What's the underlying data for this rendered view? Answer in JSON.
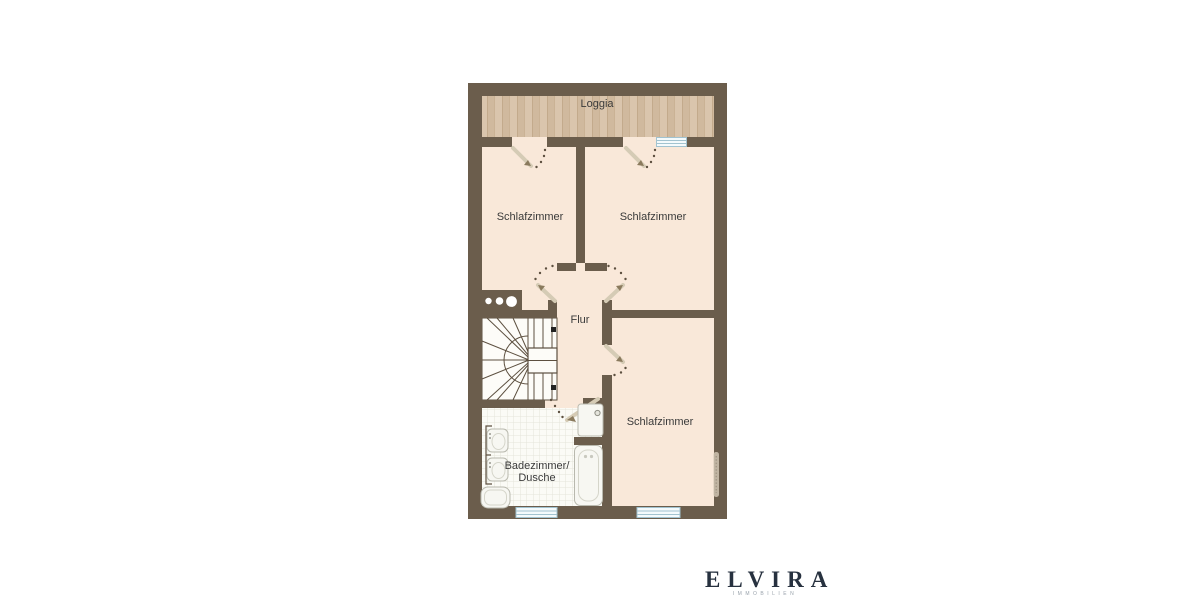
{
  "colors": {
    "wall": "#6b5d4c",
    "floor": "#f9e8d9",
    "loggia-floor": "#dac5ad",
    "loggia-plank": "#d0b99e",
    "plank-line": "#c3aa8c",
    "tile": "#fbfbf6",
    "tile-grid": "#e5e5db",
    "stair-bg": "#fdfcf8",
    "line": "#5d5040",
    "window-fill": "#f4fafc",
    "window-frame": "#a2c3d0",
    "door-leaf": "#d5cbb5",
    "door-arrow": "#8a7a5d",
    "label": "#3a3a3a",
    "logo": "#27313f",
    "logo-sub": "#9aa3ac",
    "page-bg": "#ffffff"
  },
  "rooms": {
    "loggia": {
      "label": "Loggia"
    },
    "bedroom_top_left": {
      "label": "Schlafzimmer"
    },
    "bedroom_top_right": {
      "label": "Schlafzimmer"
    },
    "hallway": {
      "label": "Flur"
    },
    "bedroom_bottom": {
      "label": "Schlafzimmer"
    },
    "bathroom": {
      "label_line1": "Badezimmer/",
      "label_line2": "Dusche"
    }
  },
  "branding": {
    "name": "ELVIRA",
    "tagline": "IMMOBILIEN"
  }
}
